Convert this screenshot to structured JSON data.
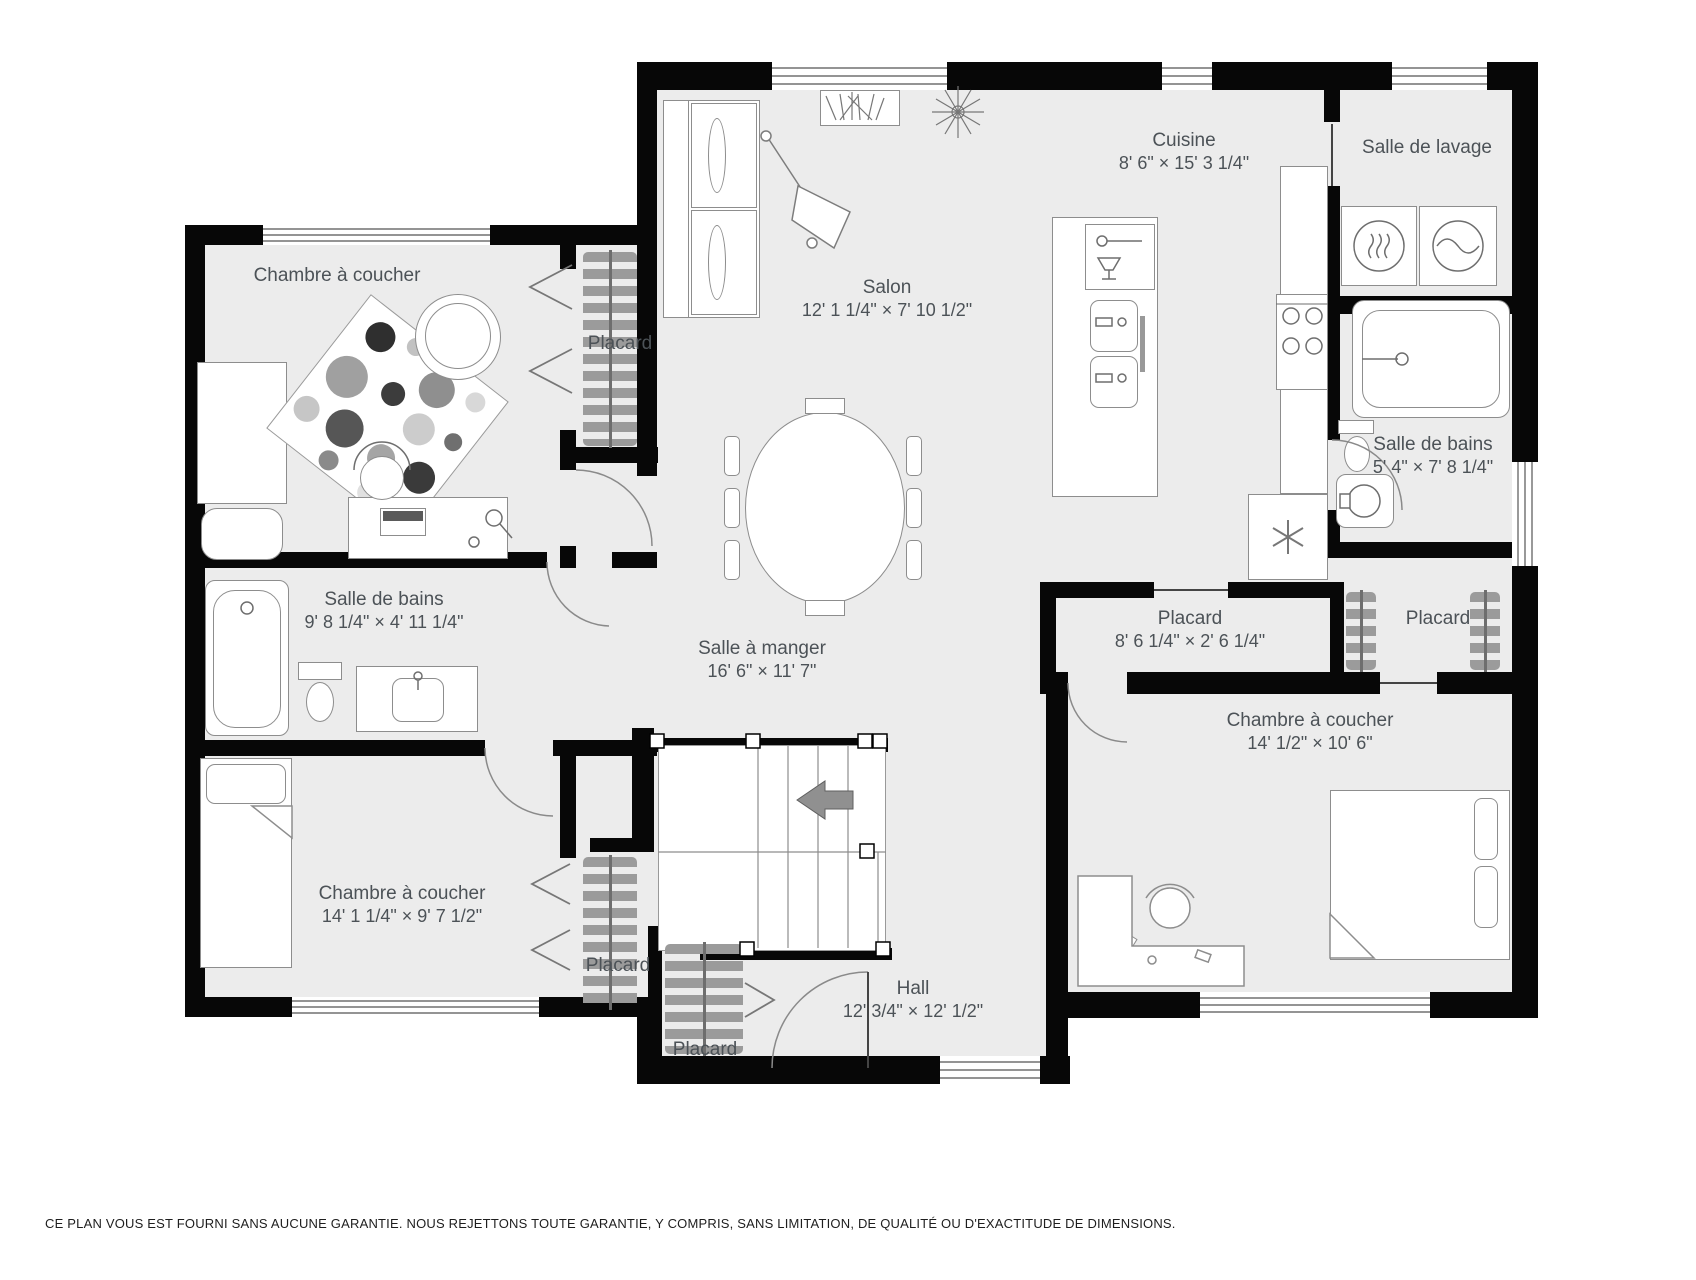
{
  "rooms": [
    {
      "name": "Chambre à coucher",
      "dims": ""
    },
    {
      "name": "Placard",
      "dims": ""
    },
    {
      "name": "Salon",
      "dims": "12' 1 1/4\" × 7' 10 1/2\""
    },
    {
      "name": "Cuisine",
      "dims": "8' 6\" × 15' 3 1/4\""
    },
    {
      "name": "Salle de lavage",
      "dims": ""
    },
    {
      "name": "Salle de bains",
      "dims": "5' 4\" × 7' 8 1/4\""
    },
    {
      "name": "Salle de bains",
      "dims": "9' 8 1/4\" × 4' 11 1/4\""
    },
    {
      "name": "Salle à manger",
      "dims": "16' 6\" × 11' 7\""
    },
    {
      "name": "Placard",
      "dims": "8' 6 1/4\" × 2' 6 1/4\""
    },
    {
      "name": "Placard",
      "dims": ""
    },
    {
      "name": "Chambre à coucher",
      "dims": "14' 1/2\" × 10' 6\""
    },
    {
      "name": "Chambre à coucher",
      "dims": "14' 1 1/4\" × 9' 7 1/2\""
    },
    {
      "name": "Placard",
      "dims": ""
    },
    {
      "name": "Placard",
      "dims": ""
    },
    {
      "name": "Hall",
      "dims": "12' 3/4\" × 12' 1/2\""
    }
  ],
  "disclaimer": "CE PLAN VOUS EST FOURNI SANS AUCUNE GARANTIE. NOUS REJETTONS TOUTE GARANTIE, Y COMPRIS, SANS LIMITATION, DE QUALITÉ OU D'EXACTITUDE DE DIMENSIONS.",
  "colors": {
    "wall": "#070707",
    "floor": "#ececec",
    "furniture_stroke": "#8d8d8d",
    "label": "#4c5257"
  }
}
